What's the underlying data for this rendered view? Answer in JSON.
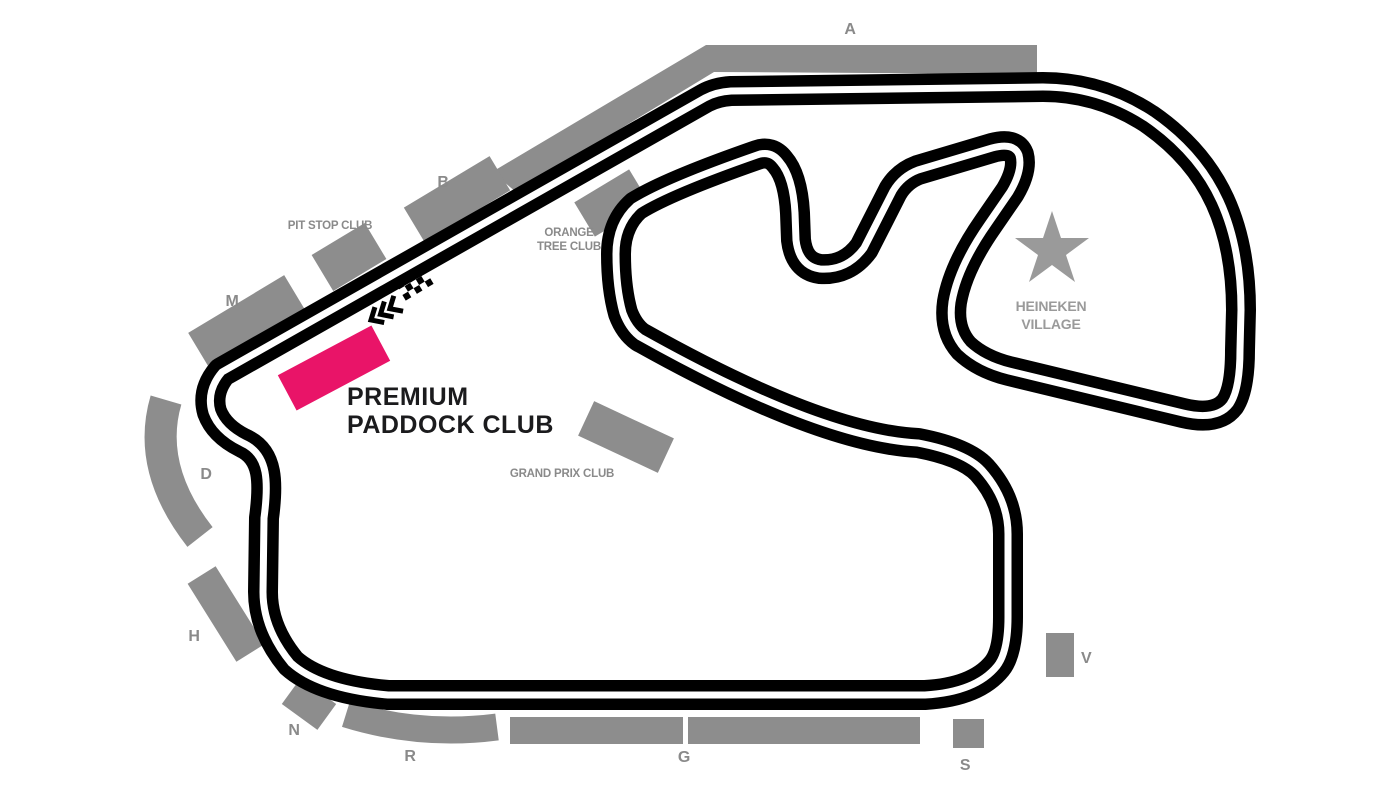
{
  "map": {
    "name": "Circuit seating map",
    "background": "#ffffff"
  },
  "track": {
    "color": "#000000",
    "centerline_color": "#ffffff"
  },
  "stands": {
    "color": "#8d8d8d",
    "label_color": "#8a8a8a",
    "items": [
      {
        "label": "A"
      },
      {
        "label": "B"
      },
      {
        "label": "M"
      },
      {
        "label": "D"
      },
      {
        "label": "H"
      },
      {
        "label": "N"
      },
      {
        "label": "R"
      },
      {
        "label": "G"
      },
      {
        "label": "S"
      },
      {
        "label": "V"
      }
    ]
  },
  "clubs": {
    "pit_stop": "PIT STOP CLUB",
    "orange_tree_line1": "ORANGE",
    "orange_tree_line2": "TREE CLUB",
    "grand_prix": "GRAND PRIX CLUB",
    "premium_line1": "PREMIUM",
    "premium_line2": "PADDOCK CLUB",
    "premium_color": "#e91468",
    "premium_text_color": "#1b1b1d"
  },
  "heineken_village": {
    "line1": "HEINEKEN",
    "line2": "VILLAGE",
    "star_color": "#9a9a9a"
  },
  "start_finish": {
    "flag_color": "#000000",
    "chevron_color": "#000000"
  }
}
